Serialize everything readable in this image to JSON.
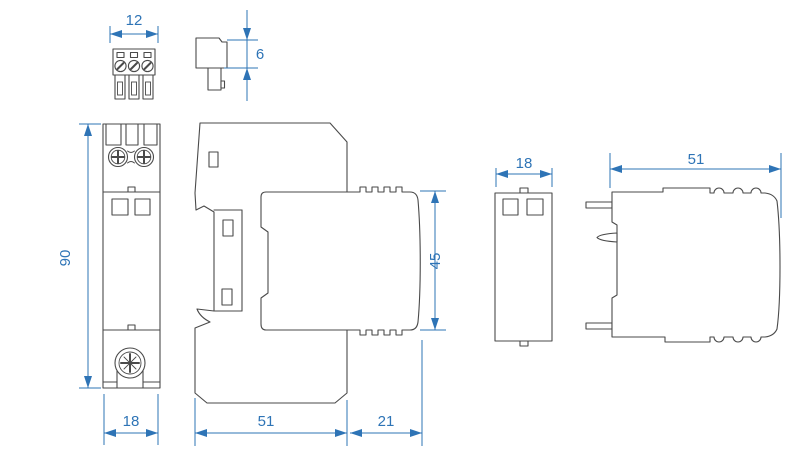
{
  "drawing": {
    "title": "surge-protection-device-dimensional-drawing",
    "units_implied": "mm",
    "dims": {
      "connector_width": "12",
      "connector_depth": "6",
      "base_height": "90",
      "base_width": "18",
      "module_height": "45",
      "base_depth": "51",
      "overhang": "21",
      "module_width": "18",
      "module_depth": "51"
    },
    "colors": {
      "dimension_blue": "#2e74b6",
      "outline_gray": "#4a4a4a",
      "background": "#ffffff"
    },
    "views": {
      "terminal_front": "plug-in-terminal-block-front-view",
      "terminal_side": "plug-in-terminal-block-side-view",
      "device_front": "din-rail-base-front-view",
      "device_side": "base-with-module-side-view",
      "module_front": "plug-in-module-front-view",
      "module_side": "plug-in-module-side-view"
    }
  }
}
